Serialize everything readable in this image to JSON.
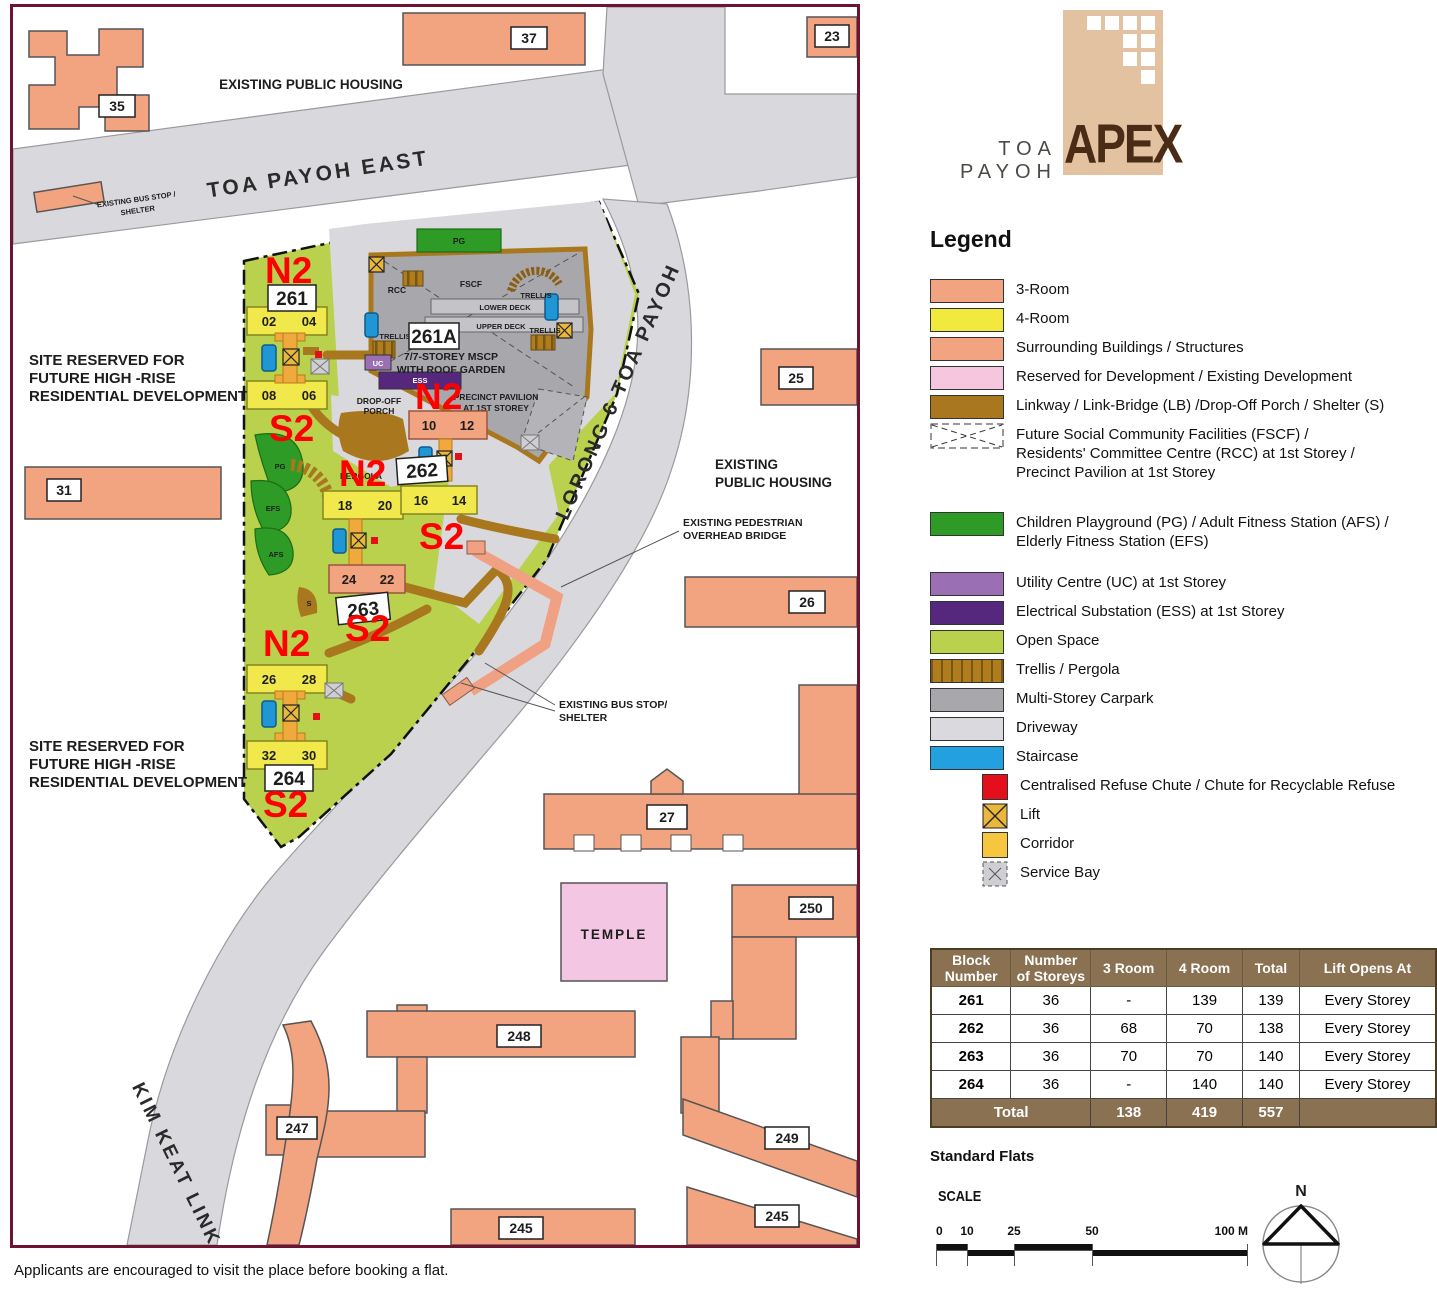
{
  "colors": {
    "map_border": "#6e1430",
    "room3_salmon": "#f2a380",
    "room4_yellow": "#f1e93e",
    "reserved_pink": "#f6c6de",
    "linkway_brown": "#a9781e",
    "facility_green": "#2e9b27",
    "uc_purple": "#9a6fb4",
    "ess_purple": "#55287d",
    "open_space": "#b9d14c",
    "mscp_gray": "#a8a8ac",
    "driveway_gray": "#dadade",
    "staircase_blue": "#23a0df",
    "refuse_red": "#e3101c",
    "corridor_gold": "#f6c63e",
    "table_header_brown": "#8a7152",
    "overlay_red": "#ff0000",
    "logo_tan": "#e2c2a0",
    "logo_text_brown": "#4a2b15"
  },
  "logo": {
    "prefix": "TOA PAYOH",
    "name": "APEX"
  },
  "legend": {
    "title": "Legend",
    "items": [
      {
        "swatch": "3-room",
        "label": "3-Room"
      },
      {
        "swatch": "4-room",
        "label": "4-Room"
      },
      {
        "swatch": "surrounding",
        "label": "Surrounding Buildings / Structures"
      },
      {
        "swatch": "reserved",
        "label": "Reserved for Development / Existing Development"
      },
      {
        "swatch": "linkway",
        "label": "Linkway / Link-Bridge (LB) /Drop-Off Porch / Shelter (S)"
      },
      {
        "swatch": "fscf-dashed-box",
        "label": "Future Social Community Facilities (FSCF) /\nResidents' Committee Centre (RCC) at 1st Storey /\nPrecinct Pavilion at 1st Storey"
      },
      {
        "swatch": "green",
        "label": "Children Playground (PG) / Adult Fitness Station (AFS) /\nElderly Fitness Station (EFS)"
      },
      {
        "swatch": "uc",
        "label": "Utility Centre (UC) at 1st Storey"
      },
      {
        "swatch": "ess",
        "label": "Electrical Substation (ESS) at 1st Storey"
      },
      {
        "swatch": "open-space",
        "label": "Open Space"
      },
      {
        "swatch": "trellis-striped",
        "label": "Trellis / Pergola"
      },
      {
        "swatch": "mscp",
        "label": "Multi-Storey Carpark"
      },
      {
        "swatch": "driveway",
        "label": "Driveway"
      },
      {
        "swatch": "staircase",
        "label": "Staircase"
      },
      {
        "swatch": "refuse-red-square",
        "label": "Centralised Refuse Chute / Chute for Recyclable Refuse"
      },
      {
        "swatch": "lift-x-box",
        "label": "Lift"
      },
      {
        "swatch": "corridor",
        "label": "Corridor"
      },
      {
        "swatch": "service-bay-x",
        "label": "Service Bay"
      }
    ]
  },
  "table": {
    "headers": [
      "Block\nNumber",
      "Number\nof Storeys",
      "3 Room",
      "4 Room",
      "Total",
      "Lift Opens At"
    ],
    "rows": [
      [
        "261",
        "36",
        "-",
        "139",
        "139",
        "Every Storey"
      ],
      [
        "262",
        "36",
        "68",
        "70",
        "138",
        "Every Storey"
      ],
      [
        "263",
        "36",
        "70",
        "70",
        "140",
        "Every Storey"
      ],
      [
        "264",
        "36",
        "-",
        "140",
        "140",
        "Every Storey"
      ]
    ],
    "total": [
      "Total",
      "138",
      "419",
      "557",
      ""
    ]
  },
  "standard_flats": "Standard Flats",
  "scale": {
    "label": "SCALE",
    "ticks": [
      "0",
      "10",
      "25",
      "50",
      "100 M"
    ]
  },
  "compass": {
    "n": "N"
  },
  "footer_note": "Applicants are encouraged to visit the place before booking a flat.",
  "map": {
    "roads": {
      "toa_payoh_east": "TOA PAYOH EAST",
      "lorong_6_toa_payoh": "LORONG 6 TOA PAYOH",
      "kim_keat_link": "KIM KEAT LINK"
    },
    "ann": {
      "existing_public_housing_top": "EXISTING PUBLIC HOUSING",
      "existing_public_housing_right": [
        "EXISTING",
        "PUBLIC HOUSING"
      ],
      "bus_stop_top": [
        "EXISTING BUS STOP /",
        "SHELTER"
      ],
      "bus_stop_bridge": [
        "EXISTING BUS STOP/",
        "SHELTER"
      ],
      "ped_bridge": [
        "EXISTING PEDESTRIAN",
        "OVERHEAD BRIDGE"
      ],
      "site_reserved": [
        "SITE RESERVED FOR",
        "FUTURE HIGH -RISE",
        "RESIDENTIAL DEVELOPMENT"
      ],
      "temple": "TEMPLE",
      "drop_off": [
        "DROP-OFF",
        "PORCH"
      ],
      "precinct": [
        "PRECINCT PAVILION",
        "AT 1ST STOREY"
      ],
      "mscp": [
        "7/7-STOREY MSCP",
        "WITH ROOF GARDEN"
      ],
      "lower_deck": "LOWER DECK",
      "upper_deck": "UPPER DECK",
      "fscf": "FSCF",
      "rcc": "RCC",
      "trellis": "TRELLIS",
      "pergola": "PERGOLA",
      "pg": "PG",
      "efs": "EFS",
      "afs": "AFS",
      "uc": "UC",
      "ess": "ESS",
      "s": "S"
    },
    "blocks": {
      "b261": "261",
      "b262": "262",
      "b263": "263",
      "b264": "264",
      "b261a": "261A"
    },
    "units": [
      "02",
      "04",
      "08",
      "06",
      "10",
      "12",
      "18",
      "20",
      "16",
      "14",
      "24",
      "22",
      "26",
      "28",
      "32",
      "30"
    ],
    "red": [
      "N2",
      "S2",
      "N2",
      "N2",
      "S2",
      "S2",
      "N2",
      "S2"
    ],
    "buildings": {
      "b35": "35",
      "b37": "37",
      "b23": "23",
      "b25": "25",
      "b26": "26",
      "b27": "27",
      "b31": "31",
      "b250": "250",
      "b248": "248",
      "b247": "247",
      "b249": "249",
      "b245a": "245",
      "b245b": "245"
    }
  }
}
